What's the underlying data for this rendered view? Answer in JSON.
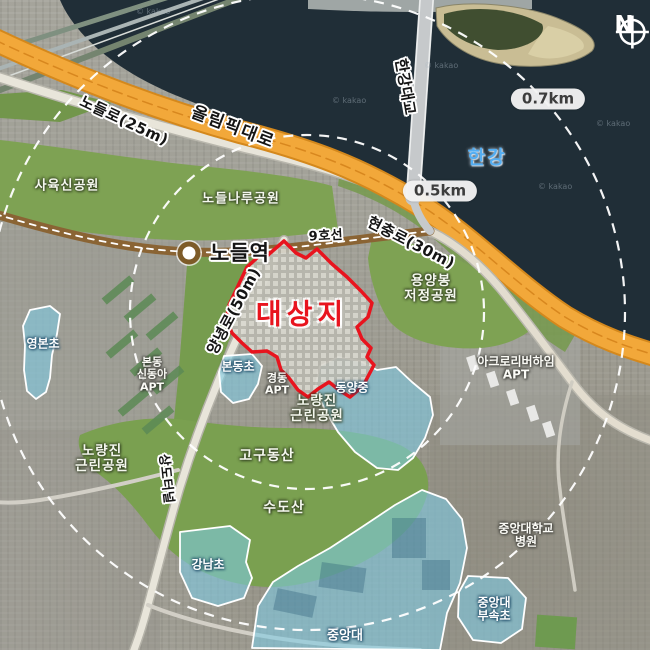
{
  "title": "대상지 위치도 (항공사진)",
  "compass": {
    "label": "N"
  },
  "river": {
    "name": "한강"
  },
  "rings": [
    {
      "label": "0.5km"
    },
    {
      "label": "0.7km"
    }
  ],
  "site": {
    "label": "대상지"
  },
  "transit": {
    "station": "노들역",
    "line": "9호선"
  },
  "roads": [
    {
      "name": "노들로(25m)"
    },
    {
      "name": "올림픽대로"
    },
    {
      "name": "한강대교"
    },
    {
      "name": "현충로(30m)"
    },
    {
      "name": "양녕로(50m)"
    },
    {
      "name": "상도터널"
    }
  ],
  "parks": [
    {
      "name": "사육신공원"
    },
    {
      "name": "노들나루공원"
    },
    {
      "name": "용양봉\n저정공원"
    },
    {
      "name": "노량진\n근린공원"
    },
    {
      "name": "고구동산"
    },
    {
      "name": "노량진\n근린공원"
    },
    {
      "name": "수도산"
    }
  ],
  "schools": [
    {
      "name": "영본초"
    },
    {
      "name": "본동초"
    },
    {
      "name": "동양중"
    },
    {
      "name": "강남초"
    },
    {
      "name": "중앙대\n부속초"
    },
    {
      "name": "중앙대"
    }
  ],
  "places": [
    {
      "name": "본동\n신동아\nAPT"
    },
    {
      "name": "경동\nAPT"
    },
    {
      "name": "아크로리버하임\nAPT"
    },
    {
      "name": "중앙대학교\n병원"
    }
  ],
  "watermark": "© kakao",
  "colors": {
    "site_red": "#e8141e",
    "road_orange": "#f0a335",
    "subway_brown": "#8a6434",
    "school_blue": "#7dcbe6",
    "water_dark": "#202e37",
    "park_green": "#7ea253",
    "ring_white": "#ffffff"
  }
}
